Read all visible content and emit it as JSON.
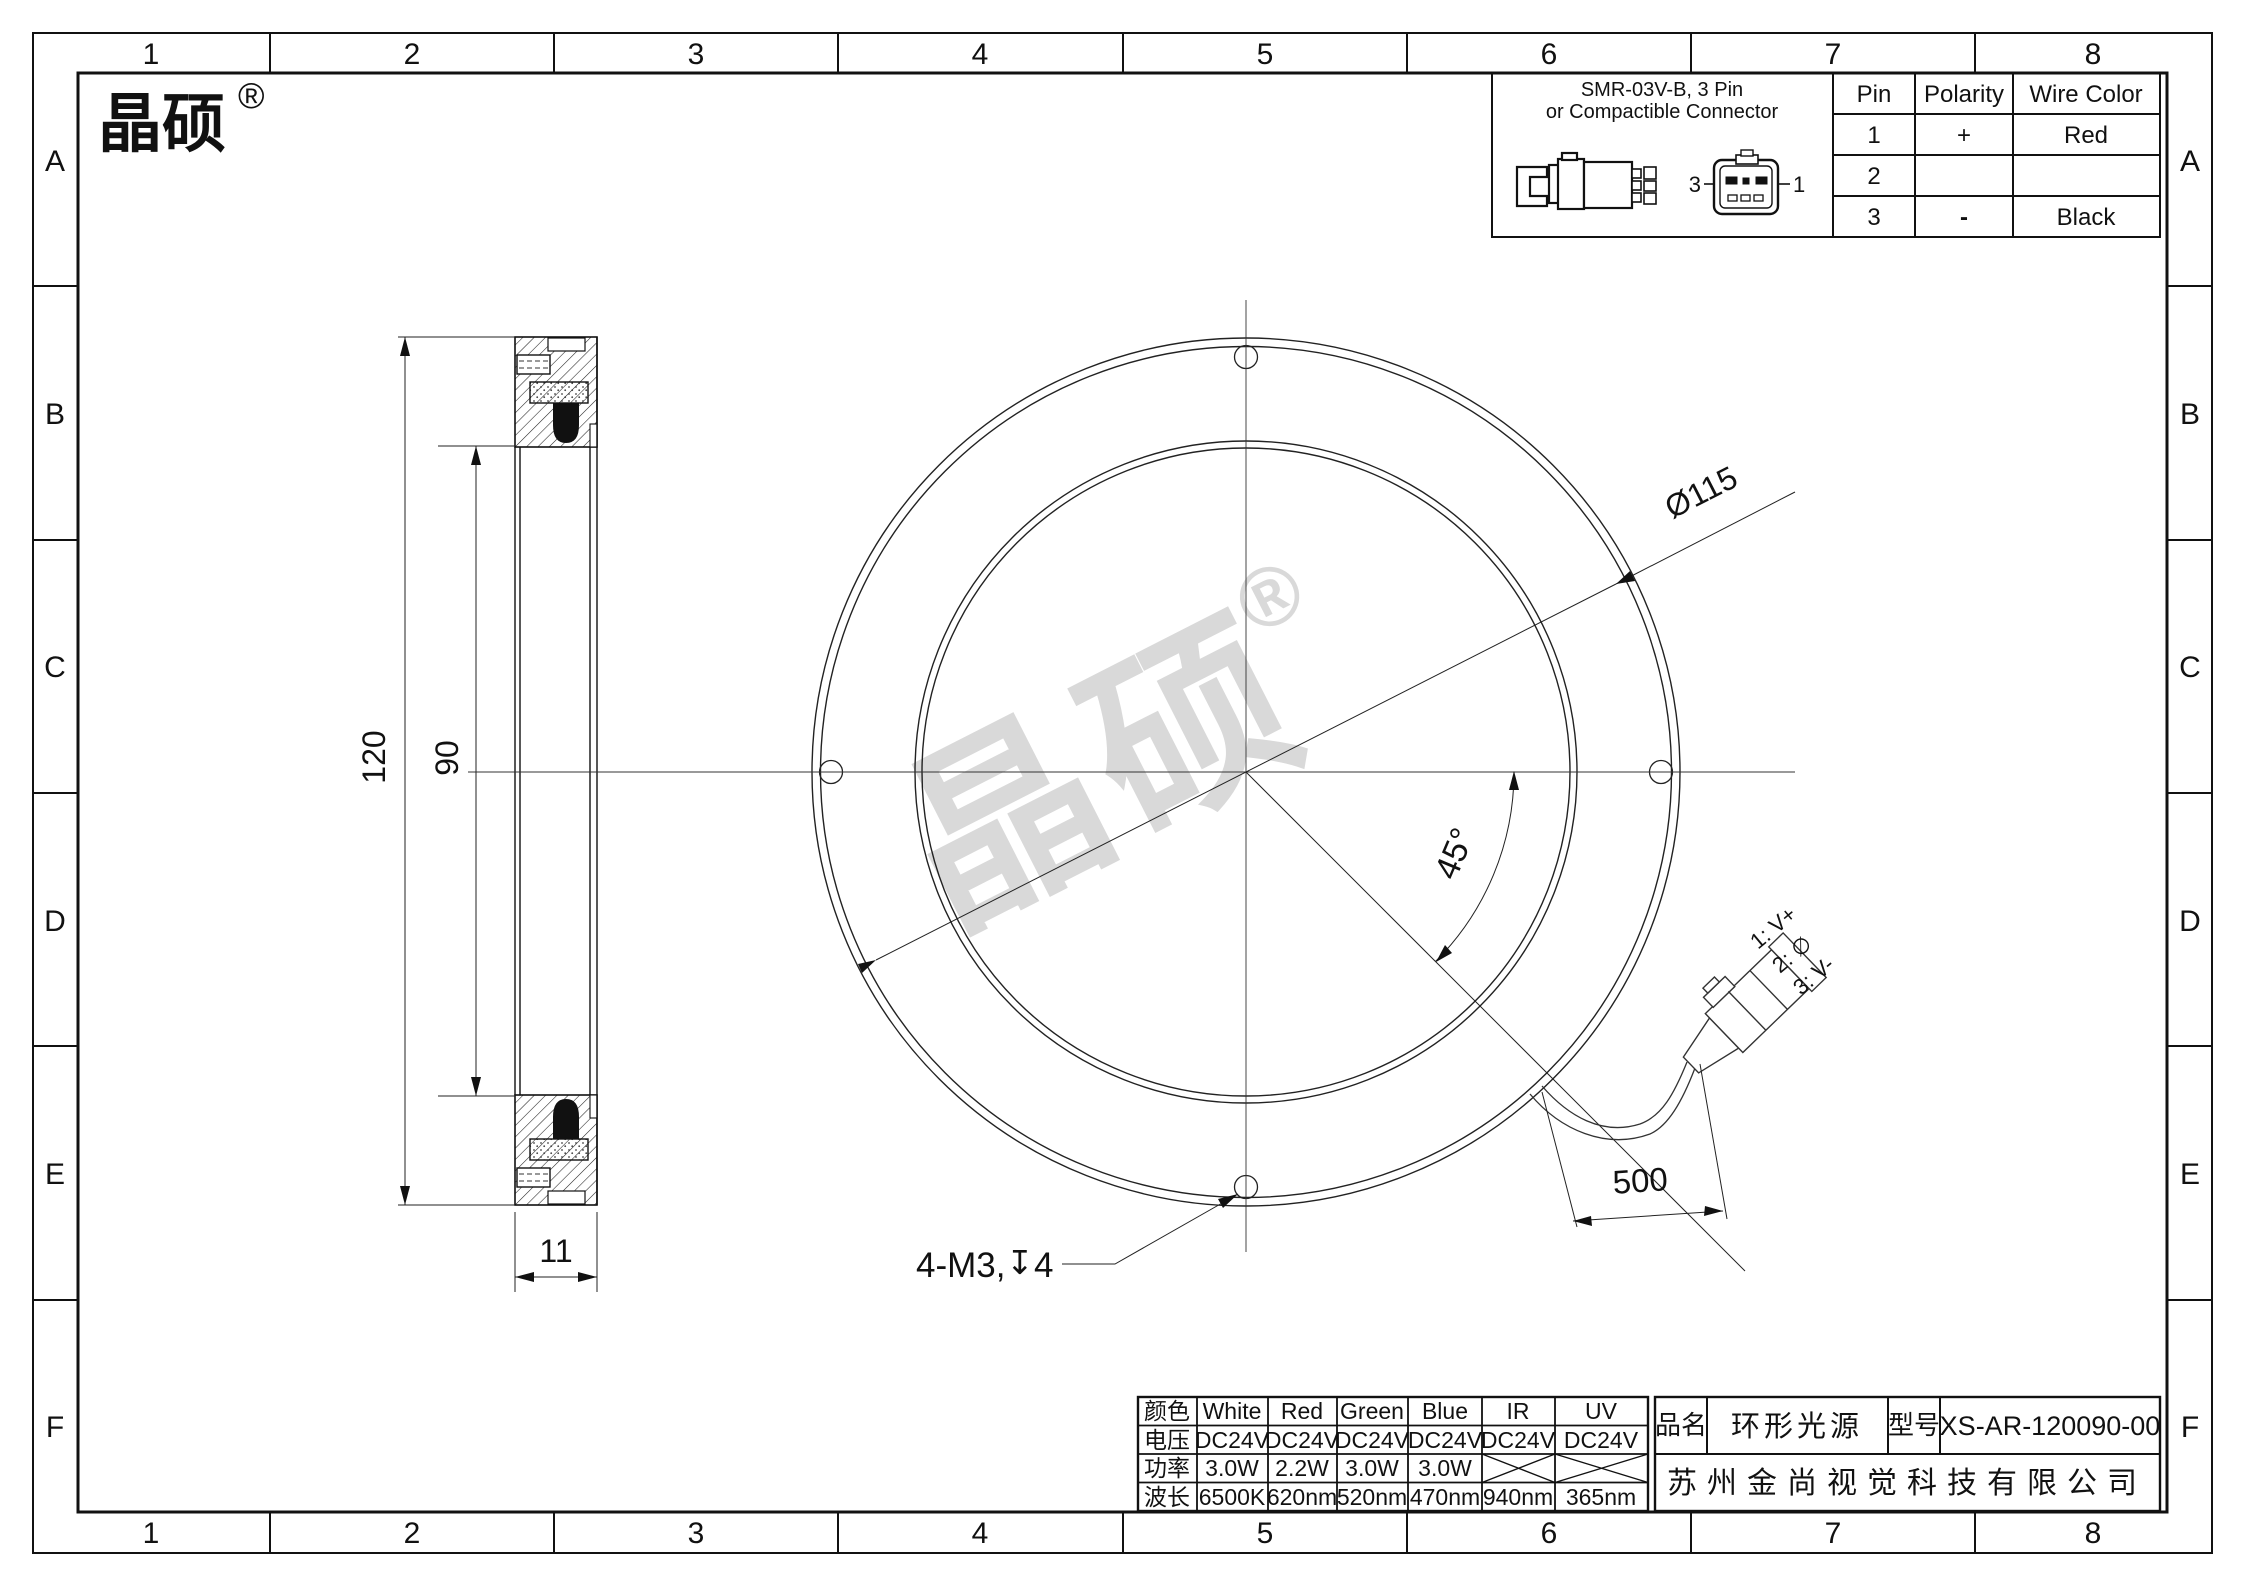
{
  "frame": {
    "columns": [
      "1",
      "2",
      "3",
      "4",
      "5",
      "6",
      "7",
      "8"
    ],
    "rows": [
      "A",
      "B",
      "C",
      "D",
      "E",
      "F"
    ]
  },
  "brand": {
    "name": "晶硕",
    "registered": "®"
  },
  "watermark": {
    "name": "晶硕",
    "registered": "®"
  },
  "connector_panel": {
    "title_line1": "SMR-03V-B, 3 Pin",
    "title_line2": "or Compactible Connector",
    "front_view_pin_left": "3",
    "front_view_pin_right": "1",
    "pin_table": {
      "headers": [
        "Pin",
        "Polarity",
        "Wire Color"
      ],
      "rows": [
        {
          "pin": "1",
          "polarity": "+",
          "wire_color": "Red"
        },
        {
          "pin": "2",
          "polarity": "",
          "wire_color": ""
        },
        {
          "pin": "3",
          "polarity": "-",
          "wire_color": "Black"
        }
      ]
    }
  },
  "dimensions": {
    "outer_diameter": "120",
    "inner_diameter": "90",
    "thickness": "11",
    "bolt_circle_diameter": "Ø115",
    "angle": "45°",
    "mounting_holes": "4-M3,",
    "depth_symbol": "↧",
    "depth_value": "4",
    "cable_length": "500"
  },
  "cable_labels": {
    "pin1": "1: V+",
    "pin2": "2: ∅",
    "pin3": "3: V-"
  },
  "spec_table": {
    "rows": [
      {
        "label": "颜色",
        "values": [
          "White",
          "Red",
          "Green",
          "Blue",
          "IR",
          "UV"
        ]
      },
      {
        "label": "电压",
        "values": [
          "DC24V",
          "DC24V",
          "DC24V",
          "DC24V",
          "DC24V",
          "DC24V"
        ]
      },
      {
        "label": "功率",
        "values": [
          "3.0W",
          "2.2W",
          "3.0W",
          "3.0W",
          "",
          ""
        ]
      },
      {
        "label": "波长",
        "values": [
          "6500K",
          "620nm",
          "520nm",
          "470nm",
          "940nm",
          "365nm"
        ]
      }
    ]
  },
  "title_block": {
    "product_label": "品名",
    "product_name": "环形光源",
    "model_label": "型号",
    "model_number": "XS-AR-120090-00",
    "company": "苏州金尚视觉科技有限公司"
  }
}
